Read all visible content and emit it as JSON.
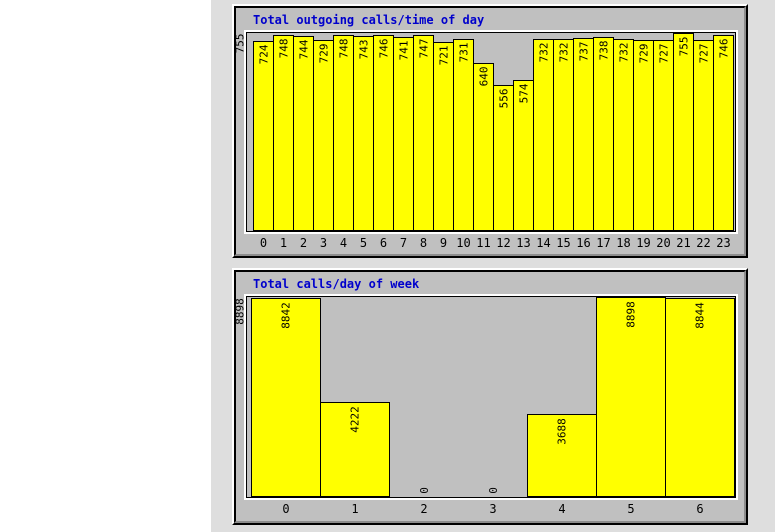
{
  "colors": {
    "page_background": "#ffffff",
    "content_background": "#dedede",
    "panel_background": "#c0c0c0",
    "bar_fill": "#ffff00",
    "bar_border": "#000000",
    "title_text": "#0000cc",
    "label_text": "#000000"
  },
  "chart_data": [
    {
      "type": "bar",
      "title": "Total outgoing calls/time of day",
      "xlabel": "",
      "ylabel": "",
      "ymax_label": "755",
      "ylim": [
        0,
        755
      ],
      "grid": false,
      "legend": null,
      "categories": [
        "0",
        "1",
        "2",
        "3",
        "4",
        "5",
        "6",
        "7",
        "8",
        "9",
        "10",
        "11",
        "12",
        "13",
        "14",
        "15",
        "16",
        "17",
        "18",
        "19",
        "20",
        "21",
        "22",
        "23"
      ],
      "values": [
        724,
        748,
        744,
        729,
        748,
        743,
        746,
        741,
        747,
        721,
        731,
        640,
        556,
        574,
        732,
        732,
        737,
        738,
        732,
        729,
        727,
        755,
        727,
        746
      ]
    },
    {
      "type": "bar",
      "title": "Total calls/day of week",
      "xlabel": "",
      "ylabel": "",
      "ymax_label": "8898",
      "ylim": [
        0,
        8898
      ],
      "grid": false,
      "legend": null,
      "categories": [
        "0",
        "1",
        "2",
        "3",
        "4",
        "5",
        "6"
      ],
      "values": [
        8842,
        4222,
        0,
        0,
        3688,
        8898,
        8844
      ]
    }
  ]
}
